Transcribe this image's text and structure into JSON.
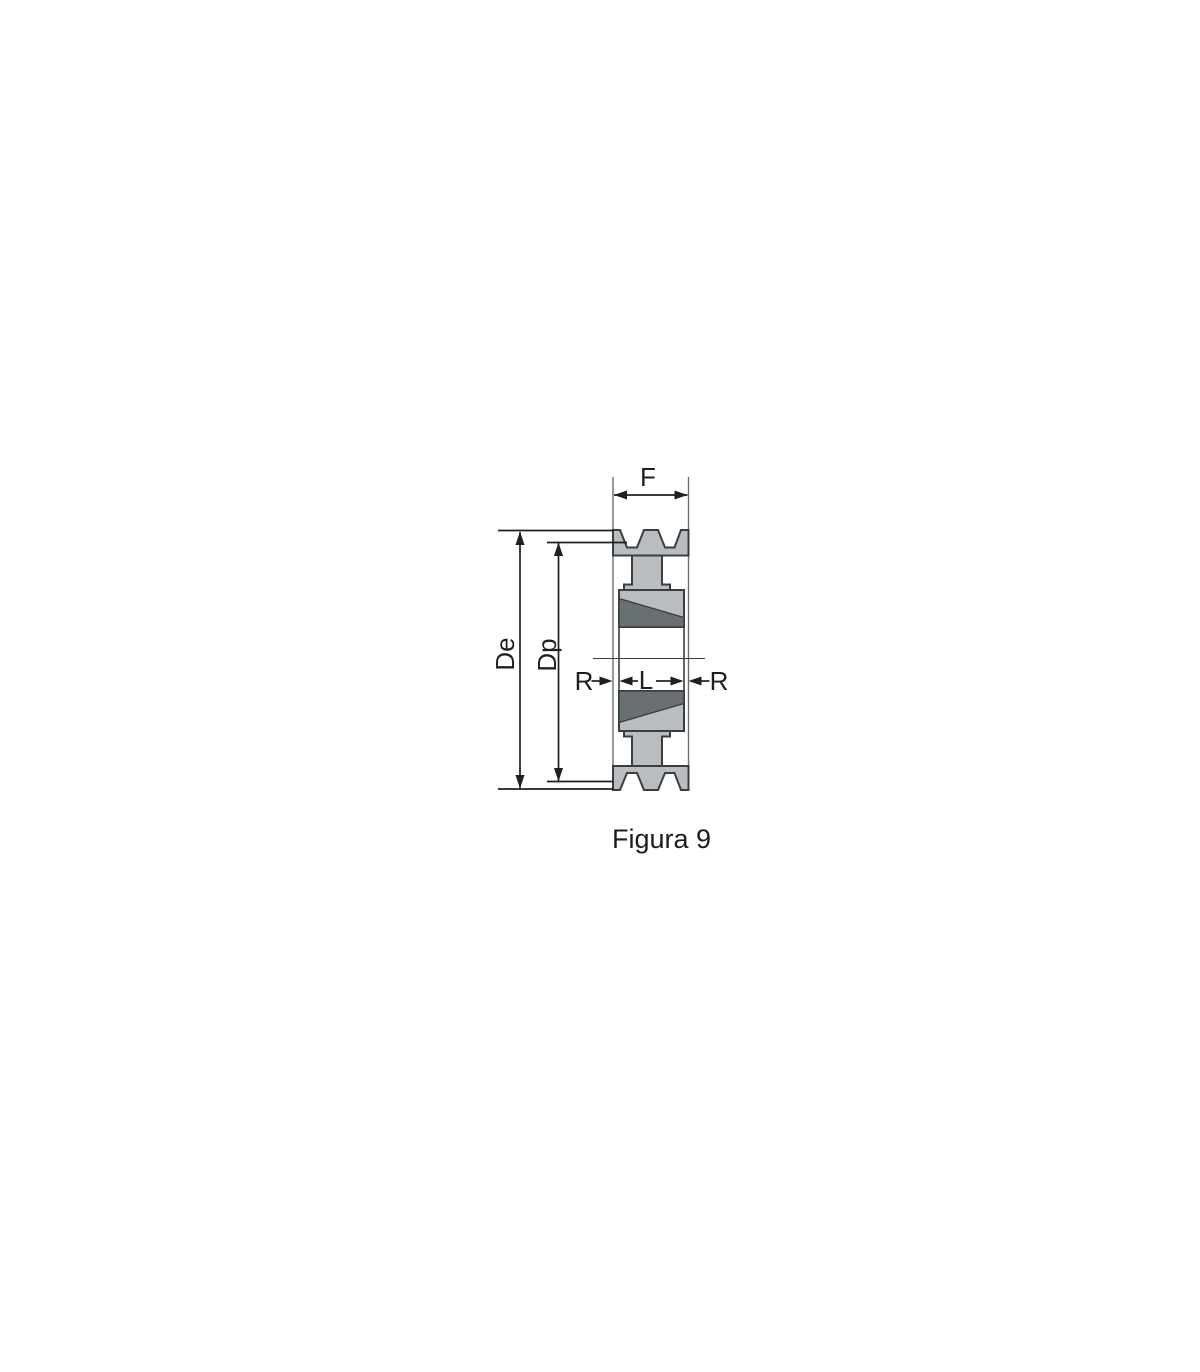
{
  "figure": {
    "caption": "Figura 9",
    "labels": {
      "face_width": "F",
      "outer_diameter": "De",
      "pitch_diameter": "Dp",
      "recess_left": "R",
      "hub_length": "L",
      "recess_right": "R"
    },
    "colors": {
      "body_fill": "#b9bdbf",
      "taper_fill": "#687073"
    }
  }
}
